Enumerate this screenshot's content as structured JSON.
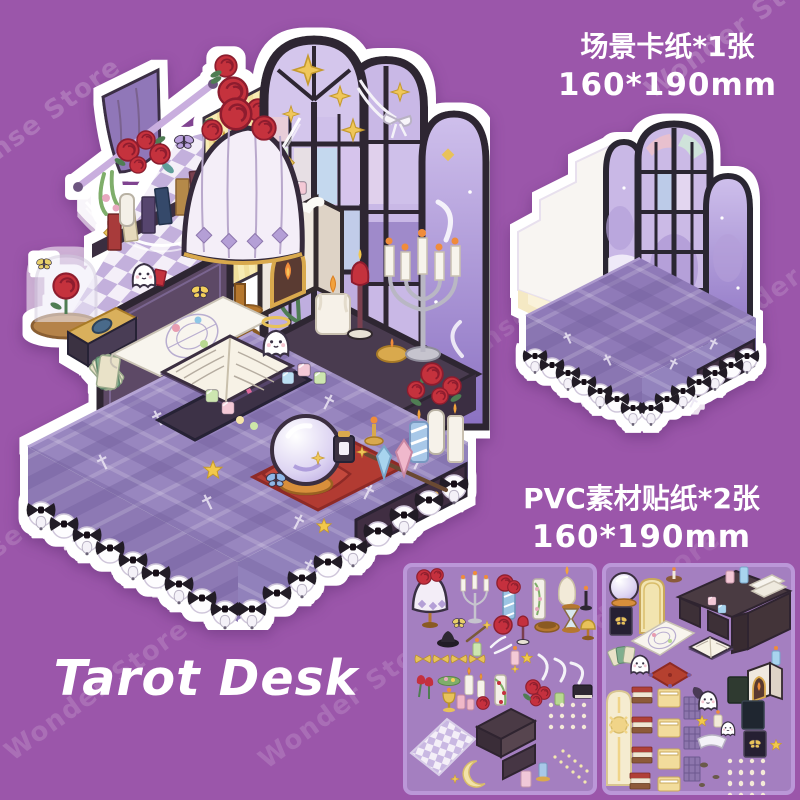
{
  "background": {
    "color": "#9b56aa"
  },
  "watermarks": {
    "brand_a": "Wonder Store",
    "brand_b": "Ense Store"
  },
  "callouts": {
    "scene_card": {
      "line1": "场景卡纸*1张",
      "line2": "160*190mm",
      "text_color": "#ffffff"
    },
    "pvc_stickers": {
      "line1": "PVC素材贴纸*2张",
      "line2": "160*190mm",
      "text_color": "#ffffff"
    }
  },
  "title": {
    "text": "Tarot Desk",
    "color": "#ffffff"
  },
  "main_sticker": {
    "description": "Isometric tarot reading room die-cut sticker scene",
    "elements": [
      "arched stained-glass windows",
      "crescent moon night window",
      "checkered star wall",
      "striped star wall with roses",
      "purple curtain",
      "star garland",
      "bookshelf with books",
      "rose bouquet",
      "tiffany rose lamp",
      "white fireplace",
      "silver candelabra",
      "candles",
      "hourglass",
      "tarot spread chart",
      "open spell book",
      "crystal ball on red cushion",
      "fanned tarot cards",
      "tarot deck box",
      "rose in glass dome",
      "little ghosts",
      "butterflies",
      "crystal cubes and shards",
      "rose vase",
      "plaid tablecloth with cross pattern",
      "black bows with white bells"
    ]
  },
  "scene_card_sticker": {
    "description": "Empty scene base: white wall, cream floor, three arched windows, plaid covered base",
    "elements": [
      "white wall",
      "cream floor",
      "three arched windows",
      "plaid table base",
      "black bows with bells"
    ]
  },
  "sticker_sheets": {
    "count": 2,
    "sheet_1_items": [
      "tiffany lamp",
      "candelabra",
      "rose pillar candle",
      "floral column",
      "melting candle",
      "black candlestick",
      "hourglass",
      "butterfly",
      "magic wand",
      "roses",
      "tulip candle",
      "wooden dish",
      "mini lamp",
      "witch hat",
      "feathers",
      "gold bows",
      "white ribbons",
      "tulips",
      "candles",
      "garland column",
      "black book",
      "gold trophy",
      "checkered rug",
      "display shelf",
      "crescent moon",
      "bead strings",
      "dot stickers"
    ],
    "sheet_2_items": [
      "crystal ball",
      "door panel",
      "cake candle",
      "tarot desk",
      "folded papers",
      "pastel candles",
      "black frame with butterfly",
      "magic circle chart",
      "open spell book",
      "tarot cards",
      "ghosts",
      "red cushion",
      "fireplace",
      "picture frames",
      "sun window panel",
      "book stacks",
      "yellow books",
      "woven panels",
      "white banner",
      "flowers",
      "dot stickers"
    ]
  },
  "colors": {
    "background": "#9b56aa",
    "sticker_outline": "#ffffff",
    "sheet_background": "#a480c2",
    "sheet_border": "#bb97d8",
    "tablecloth": "#9886bf",
    "window_frame": "#2e2733",
    "rose_red": "#c5303e",
    "star_gold": "#f0c75a"
  }
}
